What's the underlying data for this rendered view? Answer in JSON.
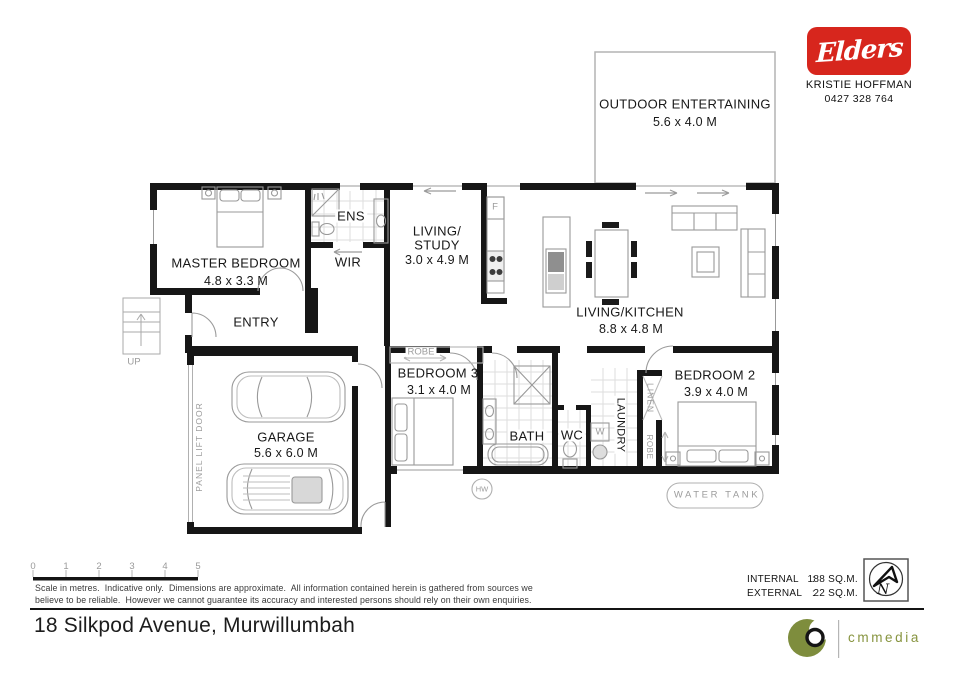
{
  "header": {
    "brand": "Elders",
    "agent": "KRISTIE HOFFMAN",
    "phone": "0427 328 764"
  },
  "rooms": {
    "outdoor": {
      "name": "OUTDOOR ENTERTAINING",
      "dims": "5.6 x 4.0 M"
    },
    "master": {
      "name": "MASTER BEDROOM",
      "dims": "4.8 x 3.3 M"
    },
    "ens": {
      "name": "ENS"
    },
    "wir": {
      "name": "WIR"
    },
    "entry": {
      "name": "ENTRY"
    },
    "living_study": {
      "line1": "LIVING/",
      "line2": "STUDY",
      "dims": "3.0 x 4.9 M"
    },
    "living_kitchen": {
      "name": "LIVING/KITCHEN",
      "dims": "8.8 x 4.8 M"
    },
    "bedroom3": {
      "name": "BEDROOM 3",
      "dims": "3.1 x 4.0 M"
    },
    "bath": {
      "name": "BATH"
    },
    "wc": {
      "name": "WC"
    },
    "laundry": {
      "name": "LAUNDRY"
    },
    "linen": {
      "name": "LINEN"
    },
    "bedroom2": {
      "name": "BEDROOM 2",
      "dims": "3.9 x 4.0 M"
    },
    "garage": {
      "name": "GARAGE",
      "dims": "5.6 x 6.0 M"
    }
  },
  "annotations": {
    "robe_bed3": "ROBE",
    "robe_bed2": "ROBE",
    "panel_lift_door": "PANEL LIFT DOOR",
    "up": "UP",
    "hw": "HW",
    "water_tank": "WATER TANK",
    "fridge": "F",
    "washer": "W",
    "compass_n": "N"
  },
  "scale": {
    "ticks": [
      "0",
      "1",
      "2",
      "3",
      "4",
      "5"
    ],
    "line1": "Scale in metres.  Indicative only.  Dimensions are approximate.  All information contained herein is gathered from sources we",
    "line2": "believe to be reliable.  However we cannot guarantee its accuracy and interested persons should rely on their own enquiries."
  },
  "areas": {
    "internal_label": "INTERNAL",
    "external_label": "EXTERNAL",
    "colon": ":",
    "internal_value": "188 SQ.M.",
    "external_value": "22 SQ.M."
  },
  "footer": {
    "address": "18 Silkpod Avenue, Murwillumbah",
    "media_brand": "cmmedia"
  },
  "colors": {
    "brand_red": "#d7261d",
    "media_olive": "#7e8d3d"
  }
}
